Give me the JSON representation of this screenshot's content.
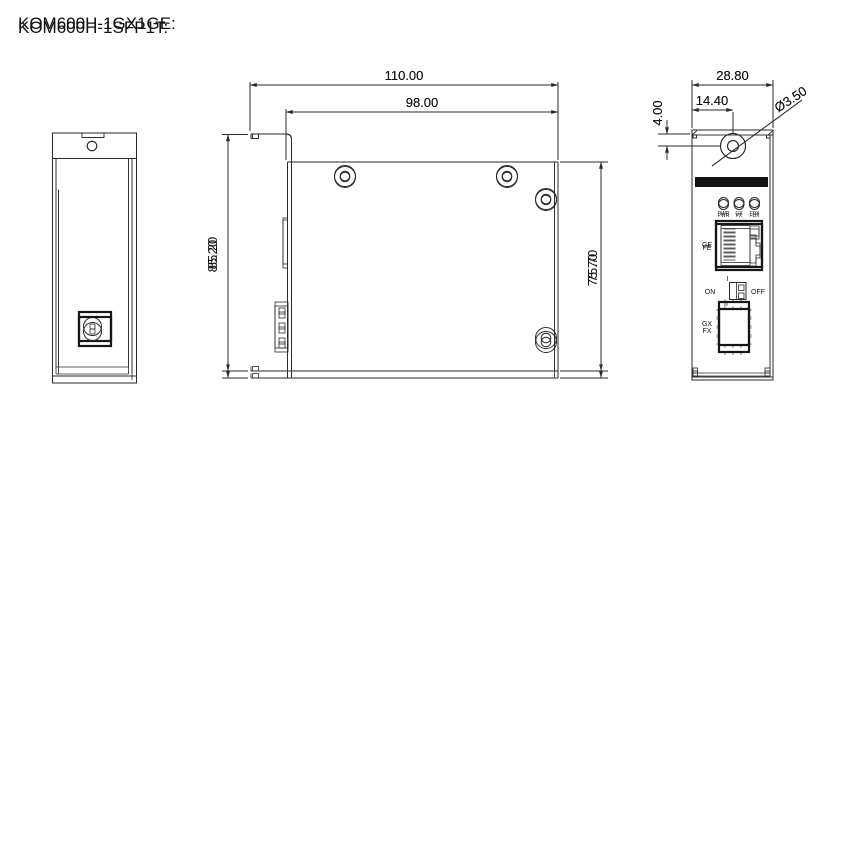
{
  "document": {
    "background": "#ffffff",
    "line_color": "#2a2a2a",
    "accent_black": "#111111"
  },
  "sections": {
    "gx1ge": {
      "title": "KOM600H-1GX1GE:",
      "dimensions": {
        "overall_width_mm": "110.00",
        "body_width_mm": "98.00",
        "overall_height_mm": "85.20",
        "body_height_mm": "75.70",
        "panel_width_mm": "28.80",
        "hole_center_mm": "14.40",
        "hole_top_offset_mm": "4.00",
        "hole_diameter_mm": "Ø3.50"
      },
      "front_panel": {
        "leds": [
          "PWR",
          "GX",
          "FDX"
        ],
        "rj45_label": "GE",
        "sfp_label": "GX"
      }
    },
    "sfp1t": {
      "title": "KOM600H-1SFP1T:",
      "dimensions": {
        "overall_width_mm": "110.00",
        "body_width_mm": "98.00",
        "overall_height_mm": "85.20",
        "body_height_mm": "75.70",
        "panel_width_mm": "28.80",
        "hole_center_mm": "14.40",
        "hole_top_offset_mm": "4.00",
        "hole_diameter_mm": "Ø3.50"
      },
      "front_panel": {
        "leds": [
          "PWR",
          "FX",
          "FDX"
        ],
        "rj45_label": "FE",
        "sfp_label": "FX",
        "power_switch": {
          "on_label": "ON",
          "off_label": "OFF",
          "position_i": "I",
          "position_ii": "II"
        }
      }
    }
  }
}
